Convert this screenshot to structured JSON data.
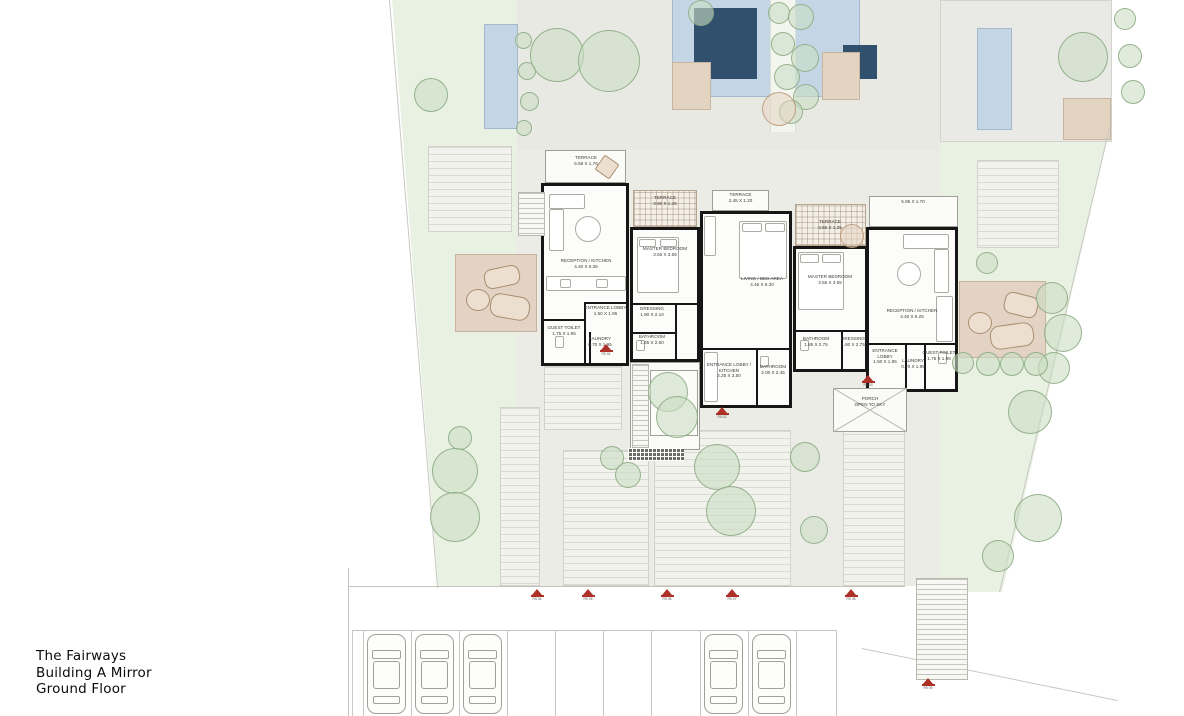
{
  "title": {
    "lines": [
      "The Fairways",
      "Building A Mirror",
      "Ground Floor"
    ]
  },
  "rooms": [
    {
      "name": "TERRACE",
      "dims": "6.58 X 1.76"
    },
    {
      "name": "RECEPTION / KITCHEN",
      "dims": "4.40 X 6.35"
    },
    {
      "name": "ENTRANCE LOBBY",
      "dims": "1.50 X 1.95"
    },
    {
      "name": "GUEST TOILET",
      "dims": "1.75 X 1.95"
    },
    {
      "name": "LAUNDRY",
      "dims": "0.70 X 1.95"
    },
    {
      "name": "TERRACE",
      "dims": "3.50 X 1.45"
    },
    {
      "name": "MASTER BEDROOM",
      "dims": "3.55 X 3.65"
    },
    {
      "name": "DRESSING",
      "dims": "1.90 X 2.10"
    },
    {
      "name": "BATHROOM",
      "dims": "1.65 X 2.60"
    },
    {
      "name": "TERRACE",
      "dims": "2.45 X 1.20"
    },
    {
      "name": "LIVING / BED AREA",
      "dims": "4.45 X 6.30"
    },
    {
      "name": "ENTRANCE LOBBY / KITCHEN",
      "dims": "2.25 X 3.50"
    },
    {
      "name": "BATHROOM",
      "dims": "2.00 X 2.45"
    },
    {
      "name": "TERRACE",
      "dims": "3.55 X 1.25"
    },
    {
      "name": "MASTER BEDROOM",
      "dims": "3.55 X 3.65"
    },
    {
      "name": "BATHROOM",
      "dims": "1.85 X 2.75"
    },
    {
      "name": "DRESSING",
      "dims": "1.80 X 2.75"
    },
    {
      "name": "",
      "dims": "5.95 X 1.70"
    },
    {
      "name": "RECEPTION / KITCHEN",
      "dims": "4.40 X 6.25"
    },
    {
      "name": "ENTRANCE LOBBY",
      "dims": "1.50 X 1.95"
    },
    {
      "name": "LAUNDRY",
      "dims": "0.70 X 1.95"
    },
    {
      "name": "GUEST TOILET",
      "dims": "1.75 X 1.95"
    },
    {
      "name": "PORCH",
      "dims": "OPEN TO SKY"
    }
  ],
  "markers": [
    "FB 01",
    "FB 02",
    "FB 03",
    "FB 04",
    "FB 05",
    "FB 06",
    "FB 07",
    "FB 08",
    "FB 09"
  ],
  "parking": {
    "stall_count": 10,
    "car_count": 5
  },
  "colors": {
    "lawn": "#e9f1e3",
    "paving": "#ebece6",
    "pool": "#c4d6e6",
    "pool_dark": "#31506d",
    "deck": "#e2d3c4",
    "wall": "#161616",
    "marker_red": "#ad3127"
  }
}
